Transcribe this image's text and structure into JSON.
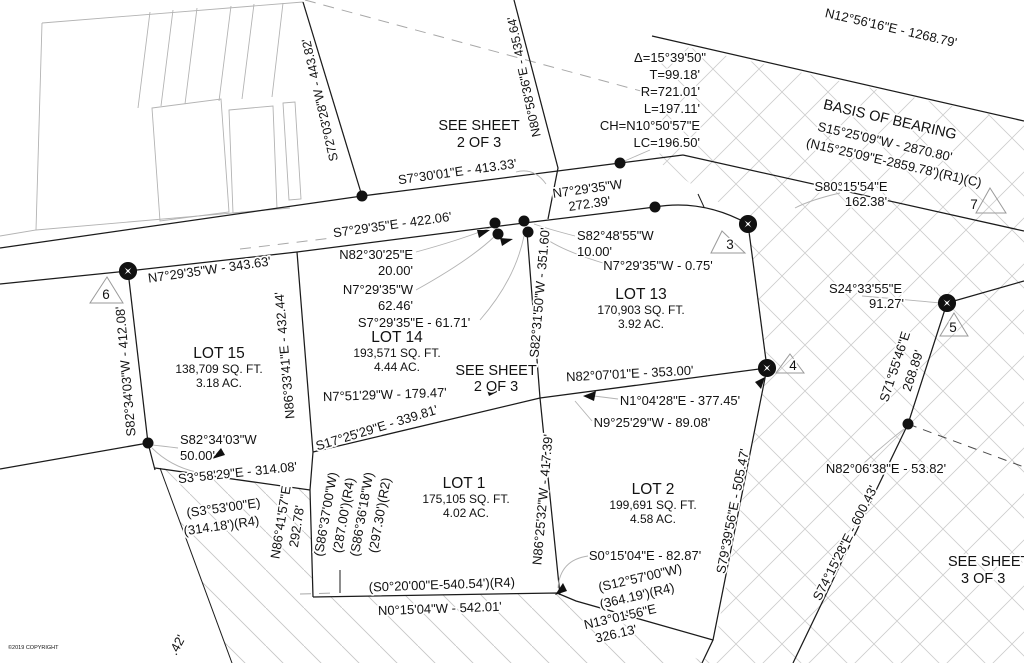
{
  "plat": {
    "copyright": "©2019 COPYRIGHT",
    "colors": {
      "line": "#1b1b1b",
      "gray_line": "#b3b3b3",
      "hatch": "#cccccc",
      "text": "#121212"
    }
  },
  "labels": [
    {
      "name": "bearing-distance-label",
      "text": "S72°03'28\"W - 443.82'",
      "x": 324,
      "y": 99,
      "rot": -103,
      "size": 12.5
    },
    {
      "name": "bearing-distance-label",
      "text": "N80°58'36\"E - 435.64'",
      "x": 528,
      "y": 76,
      "rot": -102,
      "size": 12.5
    },
    {
      "name": "sheet-reference-label",
      "text": "SEE SHEET",
      "x": 479,
      "y": 130,
      "rot": 0,
      "size": 14.5
    },
    {
      "name": "sheet-reference-label",
      "text": "2 OF 3",
      "x": 479,
      "y": 147,
      "rot": 0,
      "size": 14.5
    },
    {
      "name": "curve-data-line",
      "text": "Δ=15°39'50\"",
      "x": 706,
      "y": 62,
      "rot": 0,
      "size": 13,
      "anchor": "end"
    },
    {
      "name": "curve-data-line",
      "text": "T=99.18'",
      "x": 700,
      "y": 79,
      "rot": 0,
      "size": 13,
      "anchor": "end"
    },
    {
      "name": "curve-data-line",
      "text": "R=721.01'",
      "x": 700,
      "y": 96,
      "rot": 0,
      "size": 13,
      "anchor": "end"
    },
    {
      "name": "curve-data-line",
      "text": "L=197.11'",
      "x": 700,
      "y": 113,
      "rot": 0,
      "size": 13,
      "anchor": "end"
    },
    {
      "name": "curve-data-line",
      "text": "CH=N10°50'57\"E",
      "x": 700,
      "y": 130,
      "rot": 0,
      "size": 13,
      "anchor": "end"
    },
    {
      "name": "curve-data-line",
      "text": "LC=196.50'",
      "x": 700,
      "y": 147,
      "rot": 0,
      "size": 13,
      "anchor": "end"
    },
    {
      "name": "bearing-distance-label",
      "text": "N12°56'16\"E - 1268.79'",
      "x": 890,
      "y": 32,
      "rot": 13,
      "size": 13
    },
    {
      "name": "basis-of-bearing-title",
      "text": "BASIS OF BEARING",
      "x": 889,
      "y": 124,
      "rot": 13,
      "size": 14.5
    },
    {
      "name": "basis-of-bearing-value",
      "text": "S15°25'09\"W - 2870.80'",
      "x": 884,
      "y": 146,
      "rot": 13,
      "size": 13
    },
    {
      "name": "record-bearing-label",
      "text": "(N15°25'09\"E-2859.78')(R1)(C)",
      "x": 893,
      "y": 167,
      "rot": 13,
      "size": 13
    },
    {
      "name": "bearing-distance-label",
      "text": "S80°15'54\"E",
      "x": 851,
      "y": 191,
      "rot": 0,
      "size": 13
    },
    {
      "name": "bearing-distance-label",
      "text": "162.38'",
      "x": 866,
      "y": 206,
      "rot": 0,
      "size": 13
    },
    {
      "name": "bearing-distance-label",
      "text": "S7°30'01\"E - 413.33'",
      "x": 458,
      "y": 176,
      "rot": -8,
      "size": 13
    },
    {
      "name": "bearing-distance-label",
      "text": "N7°29'35\"W",
      "x": 588,
      "y": 193,
      "rot": -8,
      "size": 13
    },
    {
      "name": "bearing-distance-label",
      "text": "272.39'",
      "x": 590,
      "y": 208,
      "rot": -8,
      "size": 13
    },
    {
      "name": "bearing-distance-label",
      "text": "S7°29'35\"E - 422.06'",
      "x": 393,
      "y": 229,
      "rot": -8,
      "size": 13
    },
    {
      "name": "bearing-distance-label",
      "text": "N82°30'25\"E",
      "x": 413,
      "y": 259,
      "rot": 0,
      "size": 13,
      "anchor": "end"
    },
    {
      "name": "bearing-distance-label",
      "text": "20.00'",
      "x": 413,
      "y": 275,
      "rot": 0,
      "size": 13,
      "anchor": "end"
    },
    {
      "name": "bearing-distance-label",
      "text": "N7°29'35\"W",
      "x": 413,
      "y": 294,
      "rot": 0,
      "size": 13,
      "anchor": "end"
    },
    {
      "name": "bearing-distance-label",
      "text": "62.46'",
      "x": 413,
      "y": 310,
      "rot": 0,
      "size": 13,
      "anchor": "end"
    },
    {
      "name": "bearing-distance-label",
      "text": "S7°29'35\"E - 61.71'",
      "x": 414,
      "y": 327,
      "rot": 0,
      "size": 13
    },
    {
      "name": "lot-title",
      "text": "LOT 14",
      "x": 397,
      "y": 342,
      "rot": 0,
      "size": 15.5
    },
    {
      "name": "lot-area-label",
      "text": "193,571 SQ. FT.",
      "x": 397,
      "y": 357,
      "rot": 0,
      "size": 12
    },
    {
      "name": "lot-area-label",
      "text": "4.44 AC.",
      "x": 397,
      "y": 371,
      "rot": 0,
      "size": 12
    },
    {
      "name": "bearing-distance-label",
      "text": "S82°48'55\"W",
      "x": 577,
      "y": 240,
      "rot": 0,
      "size": 13,
      "anchor": "start"
    },
    {
      "name": "bearing-distance-label",
      "text": "10.00'",
      "x": 577,
      "y": 256,
      "rot": 0,
      "size": 13,
      "anchor": "start"
    },
    {
      "name": "bearing-distance-label",
      "text": "N7°29'35\"W - 0.75'",
      "x": 658,
      "y": 270,
      "rot": 0,
      "size": 13
    },
    {
      "name": "lot-title",
      "text": "LOT 13",
      "x": 641,
      "y": 299,
      "rot": 0,
      "size": 15.5
    },
    {
      "name": "lot-area-label",
      "text": "170,903 SQ. FT.",
      "x": 641,
      "y": 314,
      "rot": 0,
      "size": 12
    },
    {
      "name": "lot-area-label",
      "text": "3.92 AC.",
      "x": 641,
      "y": 328,
      "rot": 0,
      "size": 12
    },
    {
      "name": "bearing-distance-label",
      "text": "S24°33'55\"E",
      "x": 902,
      "y": 293,
      "rot": 0,
      "size": 13,
      "anchor": "end"
    },
    {
      "name": "bearing-distance-label",
      "text": "91.27'",
      "x": 904,
      "y": 308,
      "rot": 0,
      "size": 13,
      "anchor": "end"
    },
    {
      "name": "bearing-distance-label",
      "text": "S71°55'46\"E",
      "x": 899,
      "y": 368,
      "rot": -72,
      "size": 13
    },
    {
      "name": "bearing-distance-label",
      "text": "268.89'",
      "x": 917,
      "y": 372,
      "rot": -72,
      "size": 13
    },
    {
      "name": "bearing-distance-label",
      "text": "N7°29'35\"W - 343.63'",
      "x": 210,
      "y": 274,
      "rot": -8,
      "size": 13
    },
    {
      "name": "bearing-distance-label",
      "text": "S82°34'03\"W - 412.08'",
      "x": 130,
      "y": 371,
      "rot": -95,
      "size": 13
    },
    {
      "name": "bearing-distance-label",
      "text": "N86°33'41\"E - 432.44'",
      "x": 289,
      "y": 355,
      "rot": -95,
      "size": 13
    },
    {
      "name": "lot-title",
      "text": "LOT 15",
      "x": 219,
      "y": 358,
      "rot": 0,
      "size": 15.5
    },
    {
      "name": "lot-area-label",
      "text": "138,709 SQ. FT.",
      "x": 219,
      "y": 373,
      "rot": 0,
      "size": 12
    },
    {
      "name": "lot-area-label",
      "text": "3.18 AC.",
      "x": 219,
      "y": 387,
      "rot": 0,
      "size": 12
    },
    {
      "name": "bearing-distance-label",
      "text": "S82°34'03\"W",
      "x": 180,
      "y": 444,
      "rot": 0,
      "size": 13,
      "anchor": "start"
    },
    {
      "name": "bearing-distance-label",
      "text": "50.00'",
      "x": 180,
      "y": 460,
      "rot": 0,
      "size": 13,
      "anchor": "start"
    },
    {
      "name": "bearing-distance-label",
      "text": "S3°58'29\"E - 314.08'",
      "x": 238,
      "y": 477,
      "rot": -6,
      "size": 13
    },
    {
      "name": "record-bearing-label",
      "text": "(S3°53'00\"E)",
      "x": 224,
      "y": 512,
      "rot": -8,
      "size": 13
    },
    {
      "name": "record-bearing-label",
      "text": "(314.18')(R4)",
      "x": 222,
      "y": 530,
      "rot": -8,
      "size": 13
    },
    {
      "name": "bearing-distance-label",
      "text": "N86°41'57\"E",
      "x": 285,
      "y": 523,
      "rot": -81,
      "size": 13
    },
    {
      "name": "bearing-distance-label",
      "text": "292.78'",
      "x": 301,
      "y": 527,
      "rot": -81,
      "size": 13
    },
    {
      "name": "record-bearing-label",
      "text": "(S86°37'00\"W)",
      "x": 330,
      "y": 515,
      "rot": -80,
      "size": 13
    },
    {
      "name": "record-bearing-label",
      "text": "(287.00')(R4)",
      "x": 348,
      "y": 516,
      "rot": -80,
      "size": 13
    },
    {
      "name": "record-bearing-label",
      "text": "(S86°36'18\"W)",
      "x": 366,
      "y": 515,
      "rot": -80,
      "size": 13
    },
    {
      "name": "record-bearing-label",
      "text": "(297.30')(R2)",
      "x": 384,
      "y": 516,
      "rot": -80,
      "size": 13
    },
    {
      "name": "bearing-distance-label",
      "text": "N7°51'29\"W - 179.47'",
      "x": 385,
      "y": 399,
      "rot": -2,
      "size": 13
    },
    {
      "name": "bearing-distance-label",
      "text": "S17°25'29\"E - 339.81'",
      "x": 378,
      "y": 432,
      "rot": -17,
      "size": 13
    },
    {
      "name": "sheet-reference-label",
      "text": "SEE SHEET",
      "x": 496,
      "y": 375,
      "rot": 0,
      "size": 14.5
    },
    {
      "name": "sheet-reference-label",
      "text": "2 OF 3",
      "x": 496,
      "y": 391,
      "rot": 0,
      "size": 14.5
    },
    {
      "name": "bearing-distance-label",
      "text": "S82°31'50\"W - 351.60'",
      "x": 544,
      "y": 293,
      "rot": -85,
      "size": 13
    },
    {
      "name": "bearing-distance-label",
      "text": "N82°07'01\"E - 353.00'",
      "x": 630,
      "y": 378,
      "rot": -3,
      "size": 13
    },
    {
      "name": "bearing-distance-label",
      "text": "N1°04'28\"E - 377.45'",
      "x": 680,
      "y": 405,
      "rot": 0,
      "size": 13
    },
    {
      "name": "bearing-distance-label",
      "text": "N9°25'29\"W - 89.08'",
      "x": 652,
      "y": 427,
      "rot": 0,
      "size": 13
    },
    {
      "name": "lot-title",
      "text": "LOT 1",
      "x": 464,
      "y": 488,
      "rot": 0,
      "size": 15.5
    },
    {
      "name": "lot-area-label",
      "text": "175,105 SQ. FT.",
      "x": 466,
      "y": 503,
      "rot": 0,
      "size": 12
    },
    {
      "name": "lot-area-label",
      "text": "4.02 AC.",
      "x": 466,
      "y": 517,
      "rot": 0,
      "size": 12
    },
    {
      "name": "bearing-distance-label",
      "text": "N86°25'32\"W - 417.39'",
      "x": 547,
      "y": 500,
      "rot": -85,
      "size": 13
    },
    {
      "name": "lot-title",
      "text": "LOT 2",
      "x": 653,
      "y": 494,
      "rot": 0,
      "size": 15.5
    },
    {
      "name": "lot-area-label",
      "text": "199,691 SQ. FT.",
      "x": 653,
      "y": 509,
      "rot": 0,
      "size": 12
    },
    {
      "name": "lot-area-label",
      "text": "4.58 AC.",
      "x": 653,
      "y": 523,
      "rot": 0,
      "size": 12
    },
    {
      "name": "bearing-distance-label",
      "text": "S0°15'04\"E - 82.87'",
      "x": 645,
      "y": 560,
      "rot": 0,
      "size": 13
    },
    {
      "name": "record-bearing-label",
      "text": "(S12°57'00\"W)",
      "x": 641,
      "y": 582,
      "rot": -13,
      "size": 13
    },
    {
      "name": "record-bearing-label",
      "text": "(364.19')(R4)",
      "x": 638,
      "y": 600,
      "rot": -13,
      "size": 13
    },
    {
      "name": "bearing-distance-label",
      "text": "N13°01'56\"E",
      "x": 621,
      "y": 621,
      "rot": -13,
      "size": 13
    },
    {
      "name": "bearing-distance-label",
      "text": "326.13'",
      "x": 617,
      "y": 638,
      "rot": -13,
      "size": 13
    },
    {
      "name": "record-bearing-label",
      "text": "(S0°20'00\"E-540.54')(R4)",
      "x": 442,
      "y": 589,
      "rot": -2,
      "size": 13
    },
    {
      "name": "bearing-distance-label",
      "text": "N0°15'04\"W - 542.01'",
      "x": 440,
      "y": 613,
      "rot": -2,
      "size": 13
    },
    {
      "name": "bearing-distance-label",
      "text": "S79°39'56\"E - 505.47'",
      "x": 737,
      "y": 512,
      "rot": -79,
      "size": 13
    },
    {
      "name": "bearing-distance-label",
      "text": "N82°06'38\"E - 53.82'",
      "x": 886,
      "y": 473,
      "rot": 0,
      "size": 13
    },
    {
      "name": "bearing-distance-label",
      "text": "S74°15'28\"E - 600.43'",
      "x": 849,
      "y": 545,
      "rot": -63,
      "size": 13
    },
    {
      "name": "sheet-reference-label",
      "text": "SEE SHEET",
      "x": 948,
      "y": 566,
      "rot": 0,
      "size": 14.5,
      "anchor": "start"
    },
    {
      "name": "sheet-reference-label",
      "text": "3 OF 3",
      "x": 961,
      "y": 583,
      "rot": 0,
      "size": 14.5,
      "anchor": "start"
    },
    {
      "name": "bearing-distance-label",
      "text": ".42'",
      "x": 181,
      "y": 647,
      "rot": -62,
      "size": 13
    },
    {
      "name": "copyright-label",
      "text": "©2019 COPYRIGHT",
      "x": 8,
      "y": 649,
      "rot": 0,
      "size": 5.5,
      "anchor": "start",
      "color": "#8a8a8a"
    }
  ],
  "monuments": {
    "dots": [
      {
        "x": 362,
        "y": 196
      },
      {
        "x": 620,
        "y": 163
      },
      {
        "x": 655,
        "y": 207
      },
      {
        "x": 495,
        "y": 223
      },
      {
        "x": 498,
        "y": 234
      },
      {
        "x": 524,
        "y": 221
      },
      {
        "x": 528,
        "y": 232
      },
      {
        "x": 148,
        "y": 443
      },
      {
        "x": 908,
        "y": 424
      }
    ],
    "stars": [
      {
        "x": 128,
        "y": 271
      },
      {
        "x": 748,
        "y": 224
      },
      {
        "x": 767,
        "y": 368
      },
      {
        "x": 947,
        "y": 303
      }
    ],
    "triangles": [
      {
        "id": "3",
        "points": "722,231 745,253 711,253",
        "lx": 730,
        "ly": 249
      },
      {
        "id": "4",
        "points": "790,354 804,373 776,373",
        "lx": 793,
        "ly": 370
      },
      {
        "id": "5",
        "points": "954,313 968,336 940,336",
        "lx": 953,
        "ly": 332
      },
      {
        "id": "6",
        "points": "107,277 123,303 90,303",
        "lx": 106,
        "ly": 299
      },
      {
        "id": "7",
        "points": "990,188 1006,213 976,213",
        "lx": 974,
        "ly": 209
      }
    ]
  }
}
